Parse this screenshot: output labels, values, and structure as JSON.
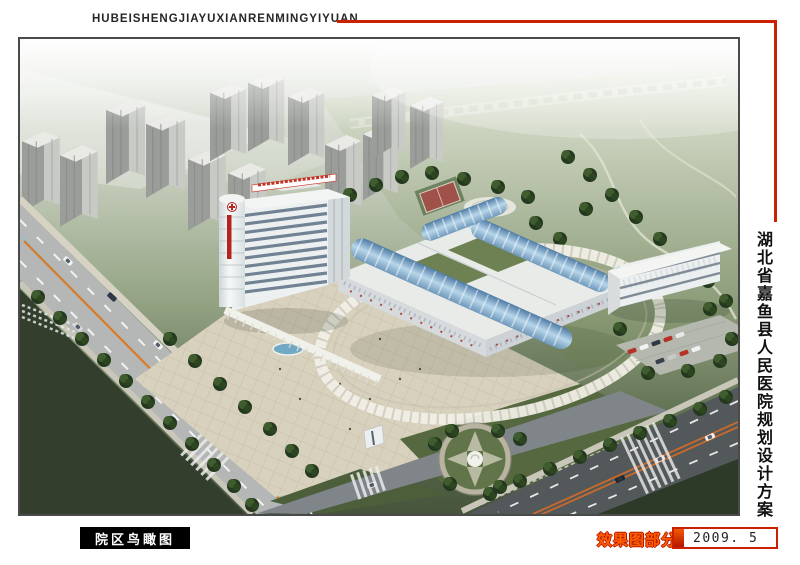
{
  "header": {
    "title": "HUBEISHENGJIAYUXIANRENMINGYIYUAN"
  },
  "side_title": {
    "text": "湖北省嘉鱼县人民医院规划设计方案"
  },
  "captions": {
    "view_label": "院区鸟瞰图",
    "section_label": "效果图部分",
    "date": "2009. 5"
  },
  "palette": {
    "accent_red": "#cc2100",
    "header_text": "#262626",
    "caption_bg": "#000000",
    "caption_text": "#ffffff",
    "section_label_color": "#ff5f00",
    "frame_border": "#4a4a4a",
    "page_bg": "#ffffff"
  }
}
